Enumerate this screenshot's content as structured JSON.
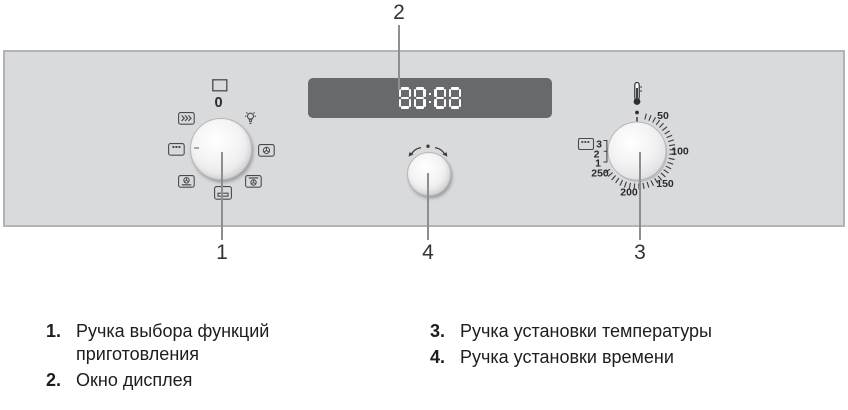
{
  "panel": {
    "function_knob": {
      "off_label": "0",
      "icons": [
        "off-square",
        "defrost",
        "lamp",
        "grill",
        "fan",
        "fan-lower-heat",
        "fan-upper-heat",
        "lower-heat"
      ]
    },
    "display": {
      "value": "88:88"
    },
    "temperature_knob": {
      "icon": "thermometer",
      "temps": [
        "50",
        "100",
        "150",
        "200",
        "250"
      ],
      "grill_levels": [
        "3",
        "2",
        "1"
      ],
      "grill_icon": "grill"
    },
    "time_knob": {
      "icon": "rotate-both-directions"
    }
  },
  "callouts": {
    "function_knob": "1",
    "display": "2",
    "temperature_knob": "3",
    "time_knob": "4"
  },
  "legend": {
    "items": [
      {
        "num": "1.",
        "text": "Ручка выбора функций приготовления"
      },
      {
        "num": "2.",
        "text": "Окно дисплея"
      },
      {
        "num": "3.",
        "text": "Ручка установки температуры"
      },
      {
        "num": "4.",
        "text": "Ручка установки времени"
      }
    ]
  }
}
